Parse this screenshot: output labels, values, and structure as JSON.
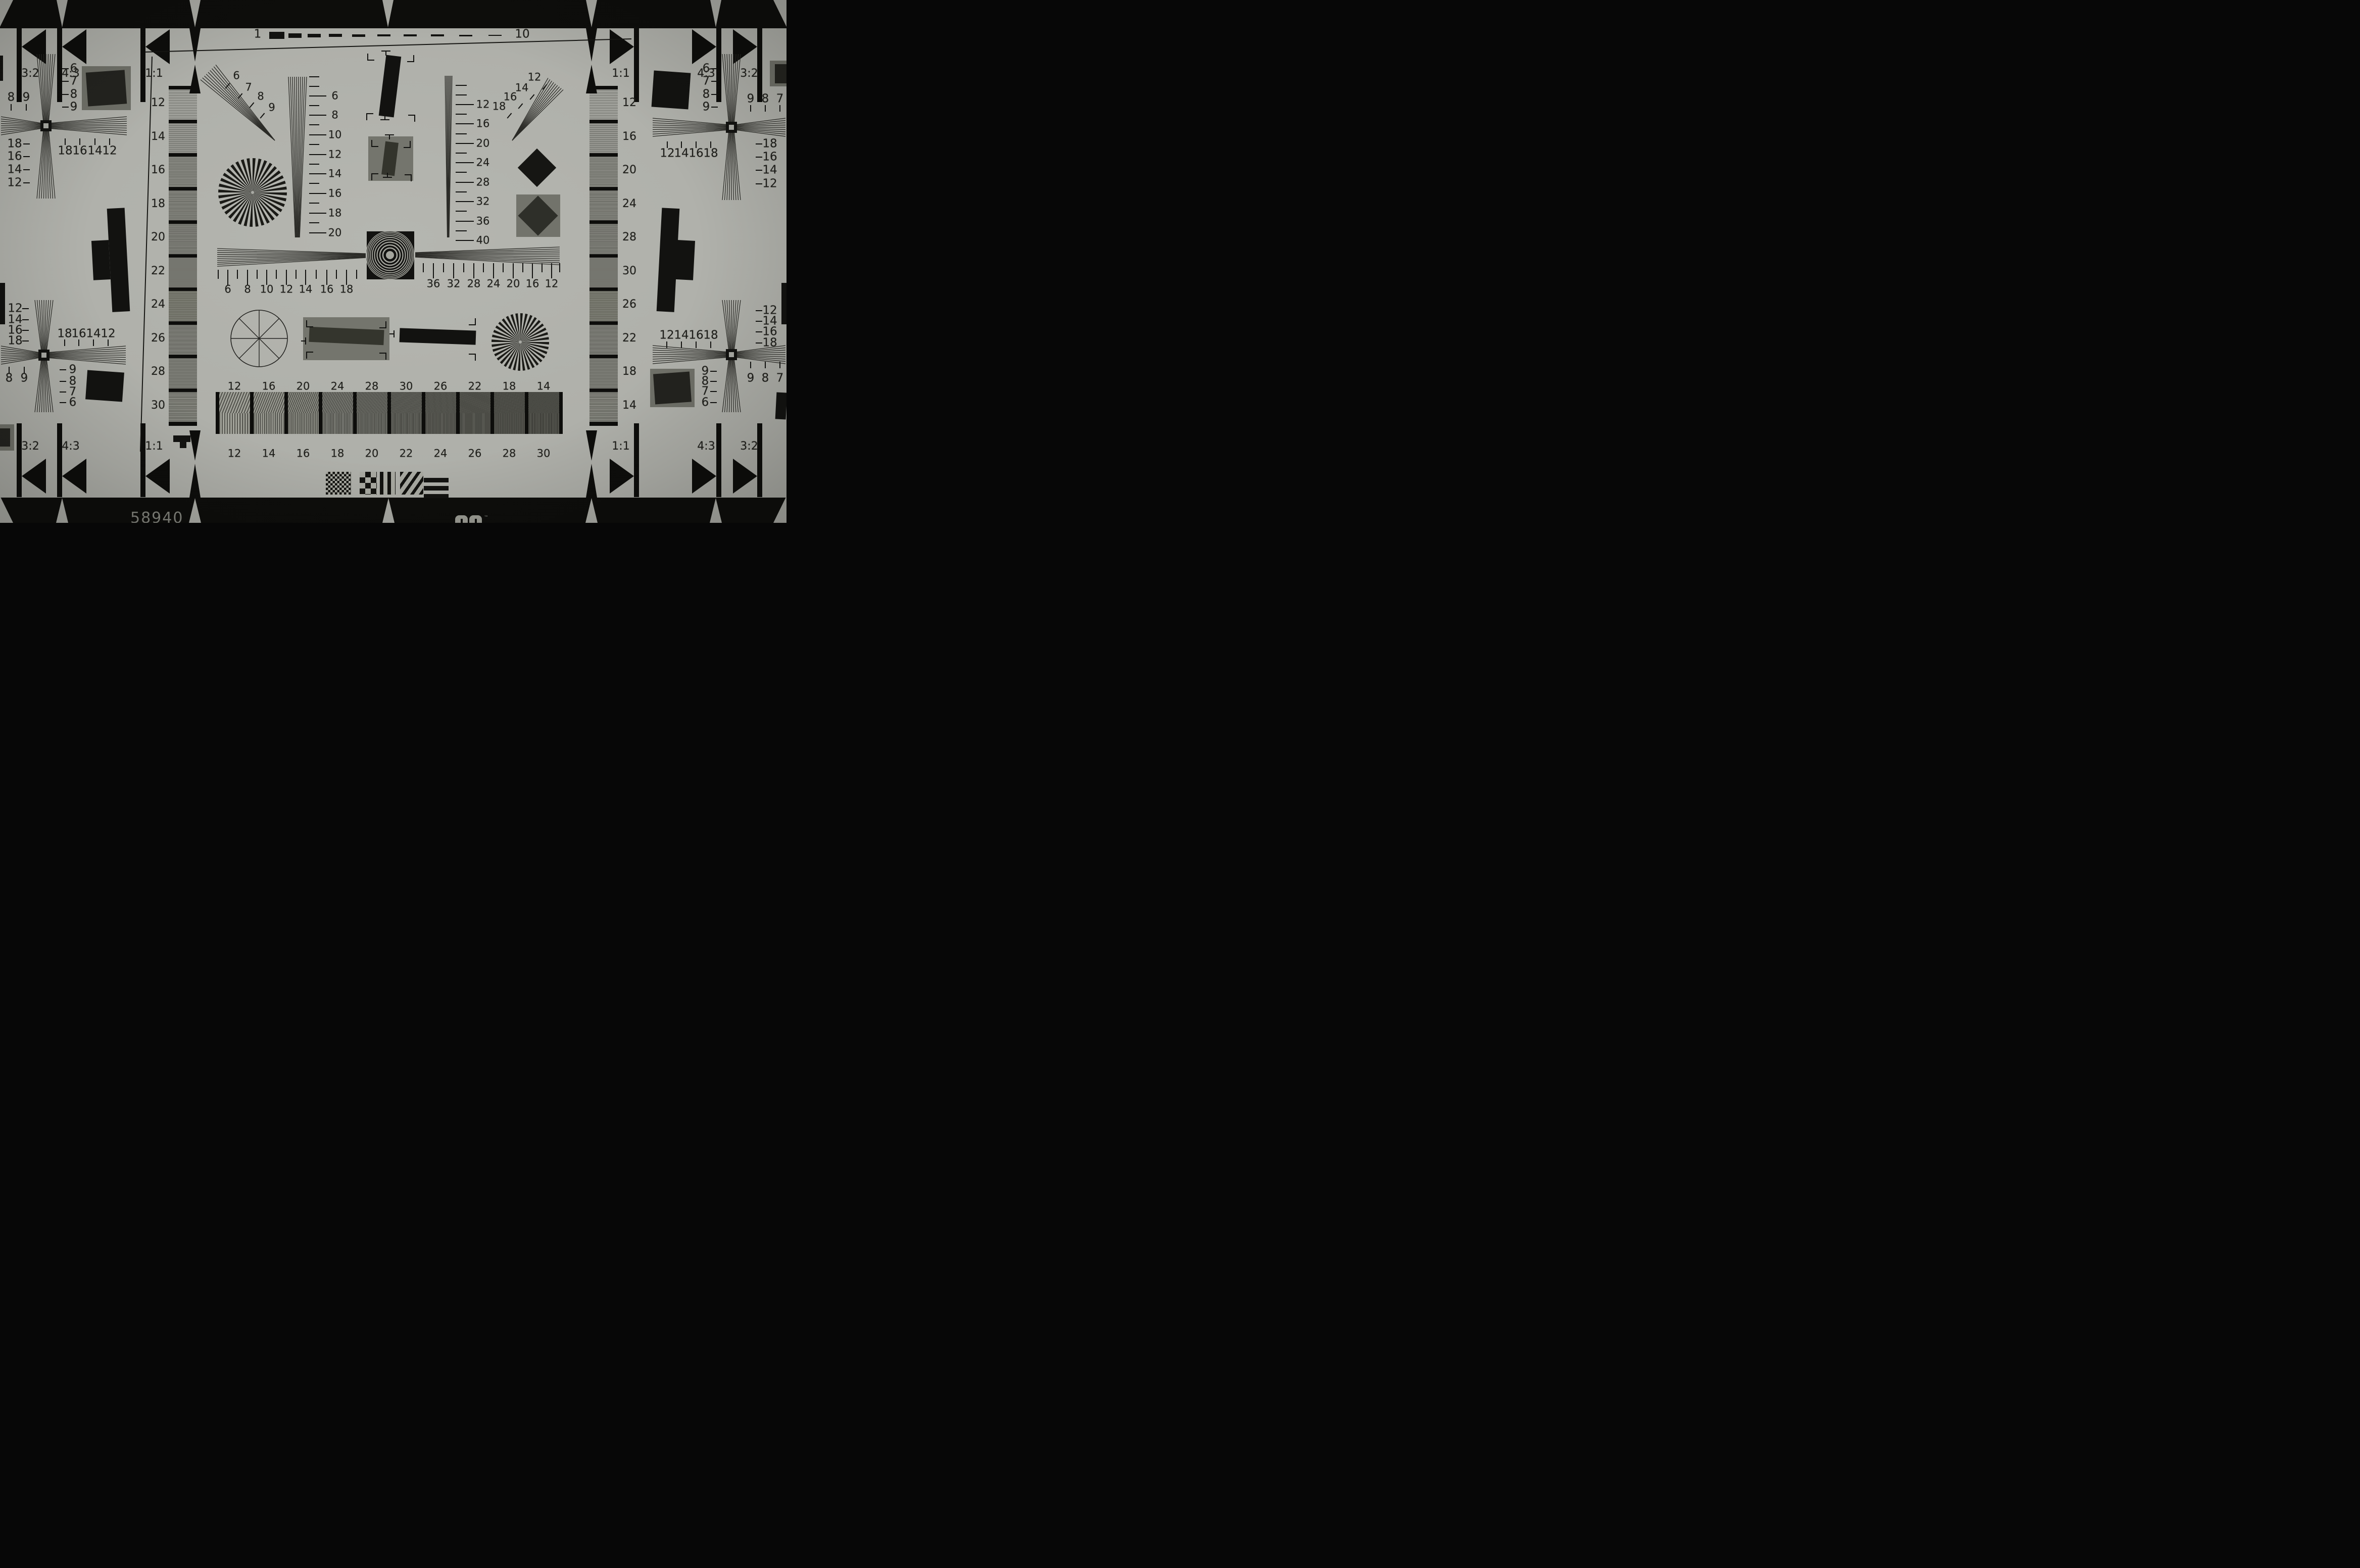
{
  "title": "Resolution test chart photograph",
  "serial": "58940",
  "logo_tm": "™",
  "colors": {
    "paper": "#afb0aa",
    "ink": "#121210",
    "band": "#0d0d0b",
    "patch_gray": "#72736b",
    "patch_dark": "#27271f",
    "ring_light": "#a4a59d",
    "text": "#1f1f1b",
    "serial_text": "#83847d"
  },
  "top_ruler": {
    "start": "1",
    "end": "10",
    "dash_count": 10
  },
  "aspect_markers": {
    "top_left": [
      "3:2",
      "4:3",
      "1:1"
    ],
    "top_right": [
      "1:1",
      "4:3",
      "3:2"
    ],
    "bottom_left": [
      "3:2",
      "4:3",
      "1:1"
    ],
    "bottom_right": [
      "1:1",
      "4:3",
      "3:2"
    ]
  },
  "crosses": {
    "top_left": {
      "right_column": [
        "6",
        "7",
        "8",
        "9"
      ],
      "left_column": [
        "18",
        "16",
        "14",
        "12"
      ],
      "bottom_row": [
        "18",
        "16",
        "14",
        "12"
      ],
      "corner_pair": [
        "8",
        "9"
      ]
    },
    "top_right": {
      "left_column": [
        "6",
        "7",
        "8",
        "9"
      ],
      "right_column": [
        "18",
        "16",
        "14",
        "12"
      ],
      "bottom_row": [
        "12",
        "14",
        "16",
        "18"
      ],
      "corner_pair": [
        "9",
        "8",
        "7"
      ]
    },
    "bottom_left": {
      "left_column": [
        "12",
        "14",
        "16",
        "18"
      ],
      "top_row": [
        "18",
        "16",
        "14",
        "12"
      ],
      "right_column": [
        "9",
        "8",
        "7",
        "6"
      ],
      "corner_pair": [
        "8",
        "9"
      ]
    },
    "bottom_right": {
      "top_row": [
        "12",
        "14",
        "16",
        "18"
      ],
      "right_column": [
        "12",
        "14",
        "16",
        "18"
      ],
      "left_column": [
        "9",
        "8",
        "7",
        "6"
      ],
      "corner_pair": [
        "9",
        "8",
        "7"
      ]
    }
  },
  "center_scales": {
    "vertical_left": [
      "6",
      "8",
      "10",
      "12",
      "14",
      "16",
      "18",
      "20"
    ],
    "vertical_right": [
      "12",
      "16",
      "20",
      "24",
      "28",
      "32",
      "36",
      "40"
    ],
    "horizontal_left": [
      "6",
      "8",
      "10",
      "12",
      "14",
      "16",
      "18"
    ],
    "horizontal_right": [
      "36",
      "32",
      "28",
      "24",
      "20",
      "16",
      "12"
    ],
    "fan_top_left": [
      "6",
      "7",
      "8",
      "9"
    ],
    "fan_top_right": [
      "12",
      "14",
      "16",
      "18"
    ]
  },
  "step_strips": {
    "left_labels": [
      "12",
      "14",
      "16",
      "18",
      "20",
      "22",
      "24",
      "26",
      "28",
      "30"
    ],
    "right_labels": [
      "12",
      "16",
      "20",
      "24",
      "28",
      "30",
      "26",
      "22",
      "18",
      "14"
    ]
  },
  "bottom_bar": {
    "top_labels": [
      "12",
      "16",
      "20",
      "24",
      "28",
      "30",
      "26",
      "22",
      "18",
      "14"
    ],
    "bottom_labels": [
      "12",
      "14",
      "16",
      "18",
      "20",
      "22",
      "24",
      "26",
      "28",
      "30"
    ]
  }
}
